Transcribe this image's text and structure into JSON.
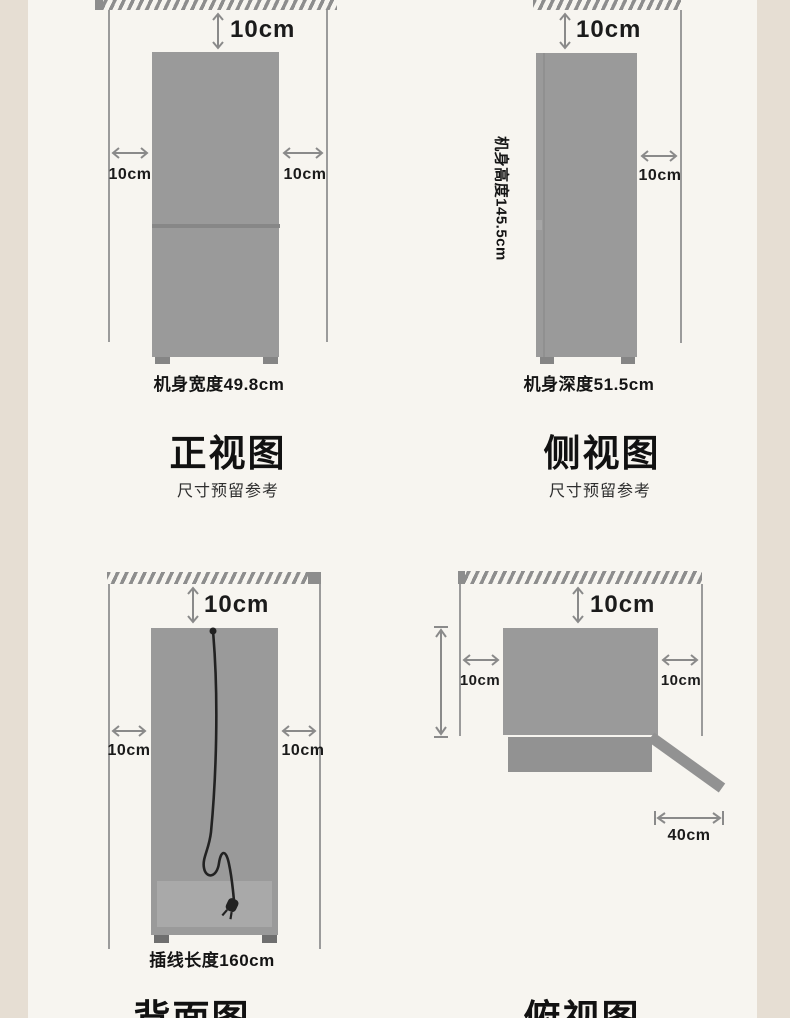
{
  "page_type": "refrigerator-installation-clearance-diagram",
  "colors": {
    "page_bg": "#f7f5f0",
    "side_strip": "#e6ded3",
    "body_gray": "#9a9a9a",
    "hatch_gray": "#8d8d8d",
    "arrow_gray": "#8a8a8a",
    "wall_line_gray": "#9b9b9b",
    "door_gray": "#929292",
    "compressor_plate_gray": "#a9a9a9",
    "cord_black": "#222222",
    "text_dark": "#141414"
  },
  "panels": {
    "front": {
      "title": "正视图",
      "subtitle": "尺寸预留参考",
      "clearance_top": "10cm",
      "clearance_left": "10cm",
      "clearance_right": "10cm",
      "dimension_label": "机身宽度49.8cm"
    },
    "side": {
      "title": "侧视图",
      "subtitle": "尺寸预留参考",
      "clearance_top": "10cm",
      "clearance_right": "10cm",
      "height_label": "机身高度145.5cm",
      "dimension_label": "机身深度51.5cm"
    },
    "back": {
      "title": "背面图",
      "clearance_top": "10cm",
      "clearance_left": "10cm",
      "clearance_right": "10cm",
      "dimension_label": "插线长度160cm"
    },
    "top": {
      "title": "俯视图",
      "clearance_top": "10cm",
      "clearance_left": "10cm",
      "clearance_right": "10cm",
      "door_swing_label": "40cm"
    }
  }
}
